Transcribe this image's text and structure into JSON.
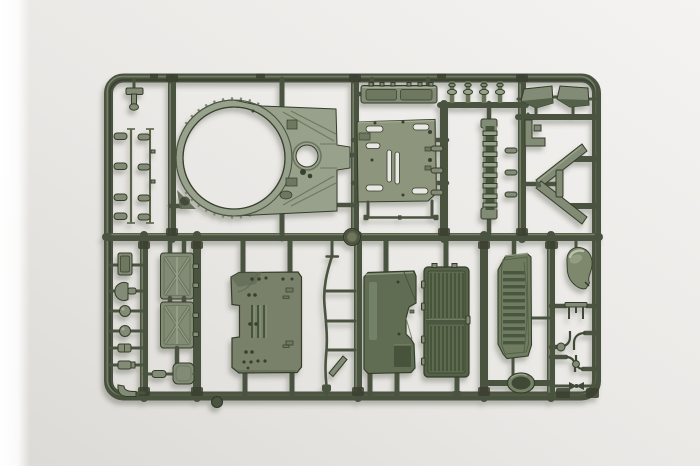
{
  "meta": {
    "scene": "Top-down studio photograph of an olive-green injection-molded plastic sprue (model kit parts tree) for a scale armored-vehicle kit, lying on a plain light-gray surface with a soft shadow and a bright white strip along the left photo edge.",
    "visible_text": "none"
  },
  "colors": {
    "bgTop": "#f4f3f1",
    "bgMid": "#eae8e5",
    "bgLow": "#dcdad6",
    "edgeWhite": "#ffffff",
    "rail": "#4a5340",
    "railHi": "#7d866c",
    "railSh": "#272d1d",
    "plastic": "#828b74",
    "plasticLight": "#98a18c",
    "plasticPale": "#a9b098",
    "deck": "#8d957d",
    "floor": "#79816b",
    "fender": "#606d52",
    "fenderDark": "#46523a",
    "door": "#55624a",
    "doorPanel": "#5d6b4f",
    "doorRib": "#47543b",
    "vent": "#6f7c60",
    "slat": "#4a5640",
    "recess": "#6e7860",
    "dark": "#39402e",
    "outline": "#343e29",
    "highlight": "#c2c8b2",
    "holeBg": "#e9e7e4",
    "hatchInner": "#3f4a36"
  },
  "sprue": {
    "material": "olive drab styrene",
    "frame": "rounded rectangular runner frame with one horizontal center runner and multiple vertical runners",
    "parts": [
      {
        "id": "turret-roof-plate",
        "label": "large roof plate with big circular ring opening and small round hatch opening"
      },
      {
        "id": "stowage-bin",
        "label": "long stowage bin with two recessed lids"
      },
      {
        "id": "small-posts",
        "label": "four small cylindrical posts"
      },
      {
        "id": "wing-left",
        "label": "angled mudguard tip (left)"
      },
      {
        "id": "wing-right",
        "label": "angled mudguard tip (right)"
      },
      {
        "id": "engine-deck-plate",
        "label": "flat deck plate with slotted openings"
      },
      {
        "id": "ladder-strip",
        "label": "narrow ribbed strip with end pads"
      },
      {
        "id": "thin-rod",
        "label": "long thin rod"
      },
      {
        "id": "l-bracket",
        "label": "small L-shaped bracket"
      },
      {
        "id": "wave-deflector",
        "label": "large chevron-shaped splash guard"
      },
      {
        "id": "peg-rows",
        "label": "two rows of small pegs on thin rods"
      },
      {
        "id": "top-bracket",
        "label": "small T-shaped bracket"
      },
      {
        "id": "fuel-tank-panel-top",
        "label": "X-braced rectangular panel (upper)"
      },
      {
        "id": "fuel-tank-panel-bottom",
        "label": "X-braced rectangular panel (lower)"
      },
      {
        "id": "flask-box",
        "label": "small rounded container"
      },
      {
        "id": "small-panel",
        "label": "small rectangular plate"
      },
      {
        "id": "headlight-cup",
        "label": "cup-shaped light housing"
      },
      {
        "id": "knob-a",
        "label": "round knob"
      },
      {
        "id": "knob-b",
        "label": "round knob"
      },
      {
        "id": "cylinder-a",
        "label": "small cylinder segment"
      },
      {
        "id": "cylinder-b",
        "label": "small cylinder segment"
      },
      {
        "id": "corner-hook",
        "label": "curved hook"
      },
      {
        "id": "hull-floor-plate",
        "label": "large floor plate with three ribs, side notch and rivet holes"
      },
      {
        "id": "curved-brace",
        "label": "thin S-curved brace with rungs and angled blade"
      },
      {
        "id": "fender-side-panel",
        "label": "side panel with recess stripe and cutout"
      },
      {
        "id": "louver-door",
        "label": "two-panel louvered door with vertical ribs"
      },
      {
        "id": "louver-vent",
        "label": "vent panel with horizontal slats"
      },
      {
        "id": "oval-hatch",
        "label": "oval hatch with raised rim"
      },
      {
        "id": "dome-hood",
        "label": "glossy teardrop dome hood"
      },
      {
        "id": "clamp-row-1",
        "label": "small two-prong clamp"
      },
      {
        "id": "clamp-row-2",
        "label": "paired wire hooks with ball"
      },
      {
        "id": "clamp-row-3",
        "label": "paired wire hooks"
      },
      {
        "id": "barbell-coupler",
        "label": "thin bar with center coupler"
      },
      {
        "id": "runner-boss",
        "label": "round runner boss at center junction"
      },
      {
        "id": "bottom-rail-boss",
        "label": "round boss under bottom rail"
      }
    ]
  }
}
